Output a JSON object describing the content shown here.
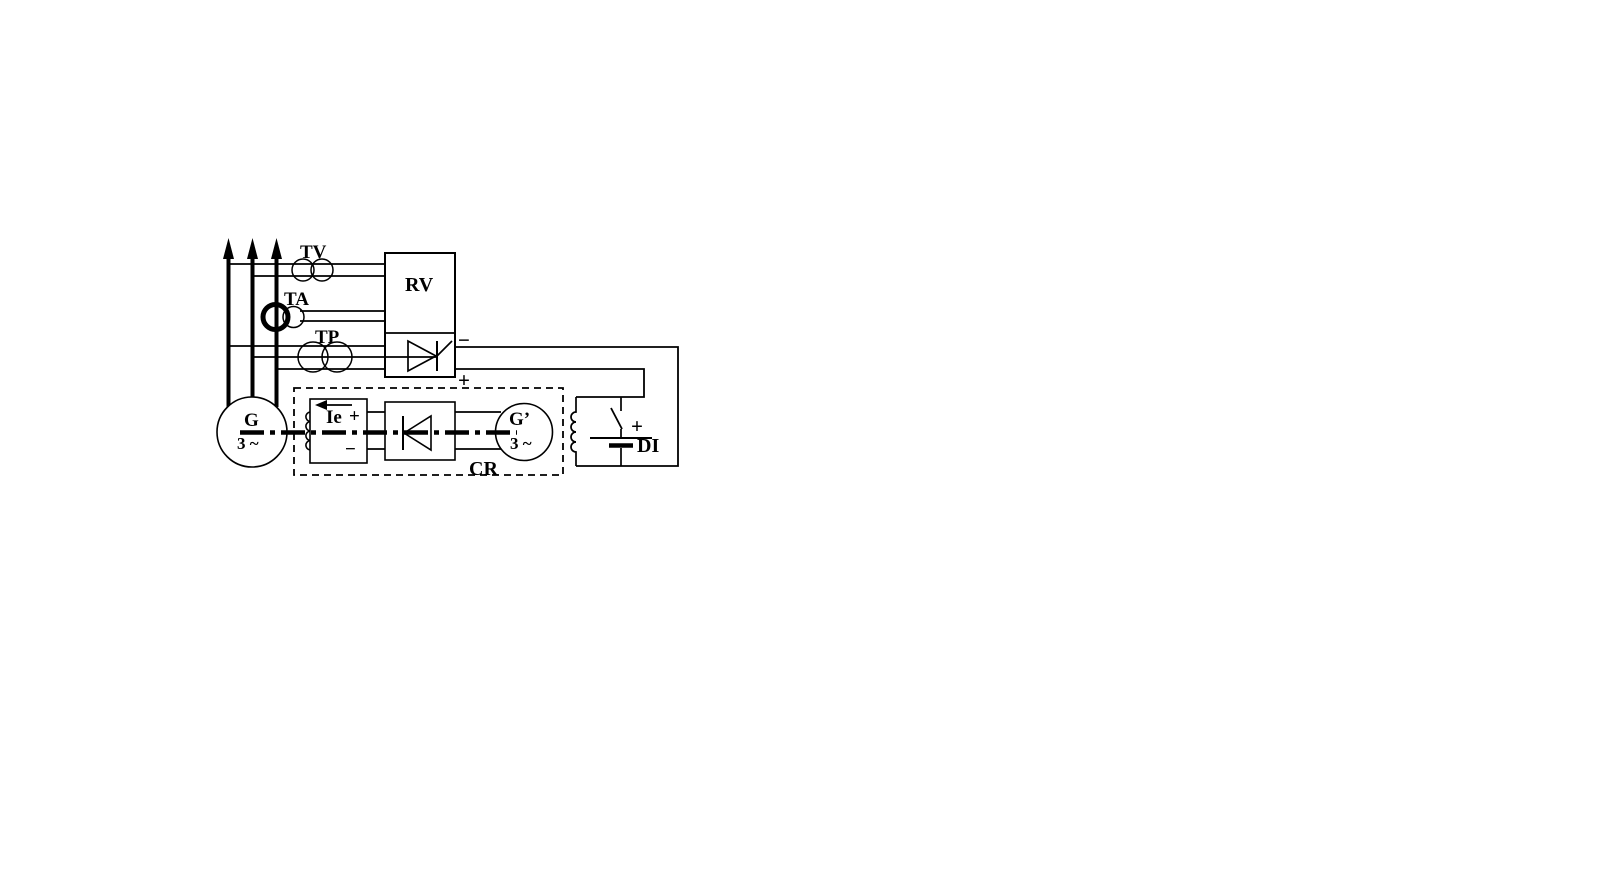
{
  "diagram": {
    "labels": {
      "tv": "TV",
      "ta": "TA",
      "tp": "TP",
      "rv": "RV",
      "rv_out_minus": "−",
      "rv_out_plus": "+",
      "ie": "Ie",
      "field_plus": "+",
      "field_minus": "−",
      "cr": "CR",
      "g_main": "G",
      "g_main_phase": "3 ~",
      "g_exciter": "G’",
      "g_exciter_phase": "3 ~",
      "battery_plus": "+",
      "di": "DI"
    },
    "colors": {
      "ink": "#000000",
      "background": "#ffffff"
    }
  }
}
